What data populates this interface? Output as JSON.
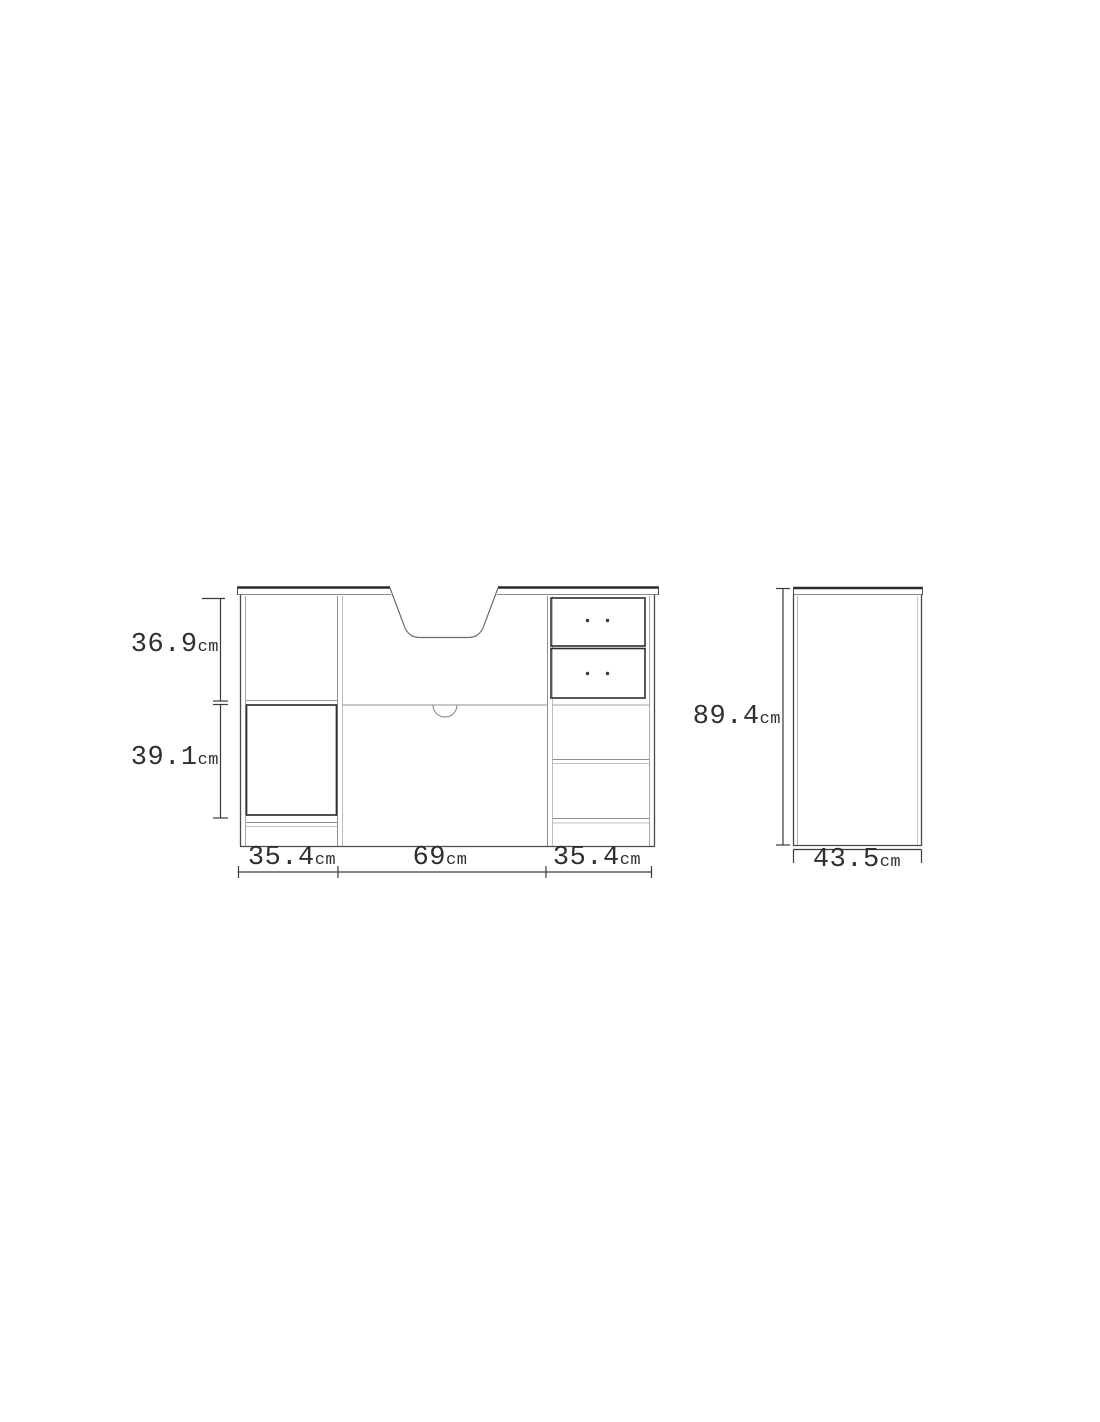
{
  "front_view": {
    "dimensions": {
      "upper_height": {
        "value": "36.9",
        "unit": "cm"
      },
      "lower_height": {
        "value": "39.1",
        "unit": "cm"
      },
      "left_width": {
        "value": "35.4",
        "unit": "cm"
      },
      "center_width": {
        "value": "69",
        "unit": "cm"
      },
      "right_width": {
        "value": "35.4",
        "unit": "cm"
      }
    }
  },
  "side_view": {
    "dimensions": {
      "height": {
        "value": "89.4",
        "unit": "cm"
      },
      "depth": {
        "value": "43.5",
        "unit": "cm"
      }
    }
  },
  "colors": {
    "background": "#ffffff",
    "outline": "#4a4a4a",
    "outline_dark": "#2b2b2b",
    "outline_light": "#a8a8a8",
    "text": "#2f2f2f"
  }
}
